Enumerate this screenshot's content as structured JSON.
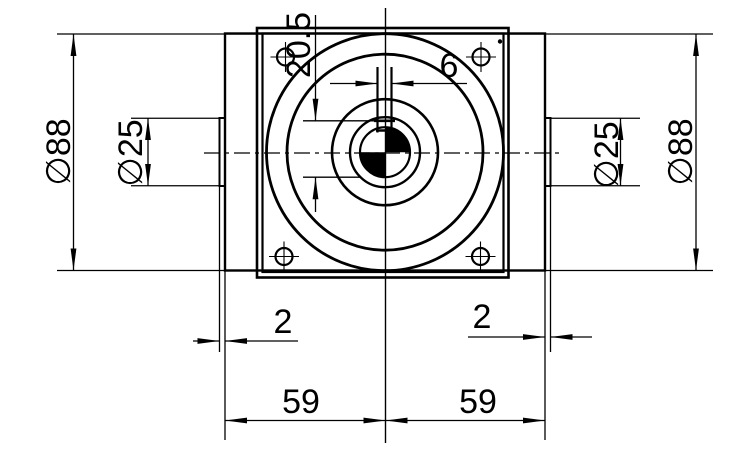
{
  "colors": {
    "background": "#ffffff",
    "lines": "#000000",
    "bore_fill": "#7d7d7d"
  },
  "dimensions": {
    "overall_diameter_left": "∅88",
    "overall_diameter_right": "∅88",
    "boss_diameter_left": "∅25",
    "boss_diameter_right": "∅25",
    "keyway_width": "6",
    "keyway_depth": "20.5",
    "cap_thickness_left": "2",
    "cap_thickness_right": "2",
    "center_to_left_face": "59",
    "center_to_right_face": "59"
  }
}
